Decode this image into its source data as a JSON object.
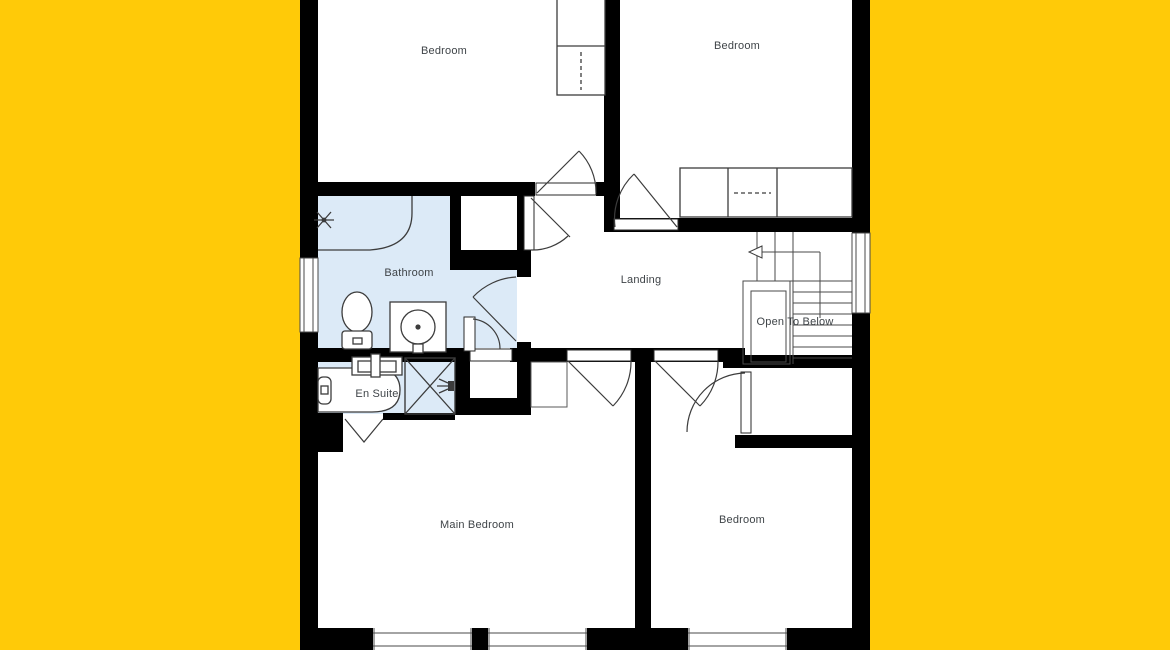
{
  "plan": {
    "type": "floor-plan-first-floor",
    "rooms": [
      {
        "id": "bedroom-top-left",
        "label": "Bedroom"
      },
      {
        "id": "bedroom-top-right",
        "label": "Bedroom"
      },
      {
        "id": "bathroom",
        "label": "Bathroom"
      },
      {
        "id": "landing",
        "label": "Landing"
      },
      {
        "id": "stairwell",
        "label": "Open To Below"
      },
      {
        "id": "en-suite",
        "label": "En Suite"
      },
      {
        "id": "main-bedroom",
        "label": "Main Bedroom"
      },
      {
        "id": "bedroom-bottom-right",
        "label": "Bedroom"
      }
    ]
  },
  "colors": {
    "background": "#ffca08",
    "wall": "#000000",
    "wet_room": "#dceaf7",
    "line": "#3c3c3c",
    "label": "#3f4448"
  }
}
